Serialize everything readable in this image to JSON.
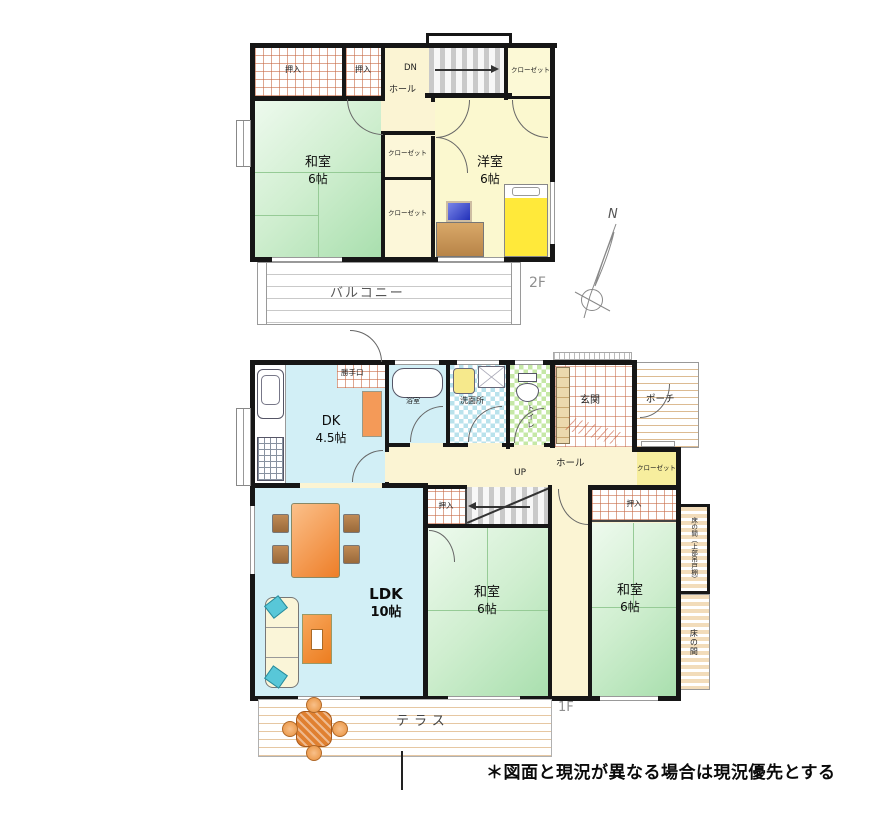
{
  "floor2": {
    "floor_label": "2F",
    "oshiire1": "押入",
    "oshiire2": "押入",
    "dn": "DN",
    "hall": "ホール",
    "closet_top_right": "クローゼット",
    "closet_mid": "クローゼット",
    "closet_bottom": "クローゼット",
    "washitsu": {
      "name": "和室",
      "size": "6帖"
    },
    "youshitsu": {
      "name": "洋室",
      "size": "6帖"
    },
    "balcony": "バルコニー"
  },
  "compass": {
    "north": "N"
  },
  "floor1": {
    "floor_label": "1F",
    "back_door": "勝手口",
    "dk": {
      "name": "DK",
      "size": "4.5帖"
    },
    "bathroom": "浴室",
    "washroom": "洗面所",
    "toilet": "トイレ",
    "entrance": "玄関",
    "porch": "ポーチ",
    "hall": "ホール",
    "up": "UP",
    "closet": "クローゼット",
    "oshiire_left": "押入",
    "oshiire_right": "押入",
    "ldk": {
      "name": "LDK",
      "size": "10帖"
    },
    "washitsu_left": {
      "name": "和室",
      "size": "6帖"
    },
    "washitsu_right": {
      "name": "和室",
      "size": "6帖"
    },
    "tokonoma_upper": "床の間（上部吊戸棚）",
    "tokonoma_lower": "床の間",
    "terrace": "テラス"
  },
  "note": "＊図面と現況が異なる場合は現況優先とする",
  "colors": {
    "wall": "#161616",
    "tatami_green": "#bfe8bf",
    "western_yellow": "#fbf8cf",
    "hall_cream": "#fbf4d3",
    "water_cyan": "#d2eff6",
    "closet_yellow": "#f7ee9e",
    "tile_grid_red": "#c76a46",
    "stripe_tan": "#dcbb92",
    "furniture_orange": "#ee7e28",
    "sofa_teal": "#58c7d8",
    "bed_yellow": "#ffe93a"
  }
}
